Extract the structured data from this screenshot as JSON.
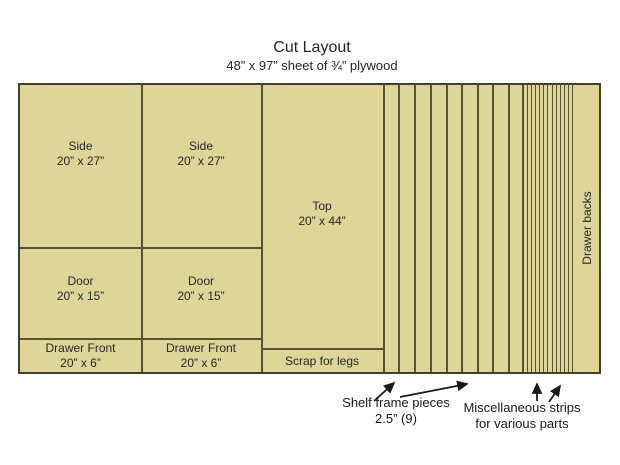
{
  "title": "Cut Layout",
  "subtitle": "48” x 97” sheet of ¾” plywood",
  "panels": {
    "side1": {
      "name": "Side",
      "dims": "20” x 27”"
    },
    "side2": {
      "name": "Side",
      "dims": "20” x 27”"
    },
    "top": {
      "name": "Top",
      "dims": "20” x 44”"
    },
    "door1": {
      "name": "Door",
      "dims": "20” x 15”"
    },
    "door2": {
      "name": "Door",
      "dims": "20” x 15”"
    },
    "drawer_front1": {
      "name": "Drawer Front",
      "dims": "20” x 6”"
    },
    "drawer_front2": {
      "name": "Drawer Front",
      "dims": "20” x 6”"
    },
    "scrap": {
      "name": "Scrap for legs"
    },
    "drawer_backs": {
      "name": "Drawer backs"
    }
  },
  "annotations": {
    "shelf": {
      "line1": "Shelf frame pieces",
      "line2": "2.5” (9)"
    },
    "misc": {
      "line1": "Miscellaneous strips",
      "line2": "for various parts"
    }
  },
  "strips": {
    "shelf_pieces_count": 9,
    "misc_strips_count": 12
  },
  "colors": {
    "panel_fill": "#ded699",
    "line": "#56512f",
    "border": "#42402a",
    "text": "#262626"
  }
}
